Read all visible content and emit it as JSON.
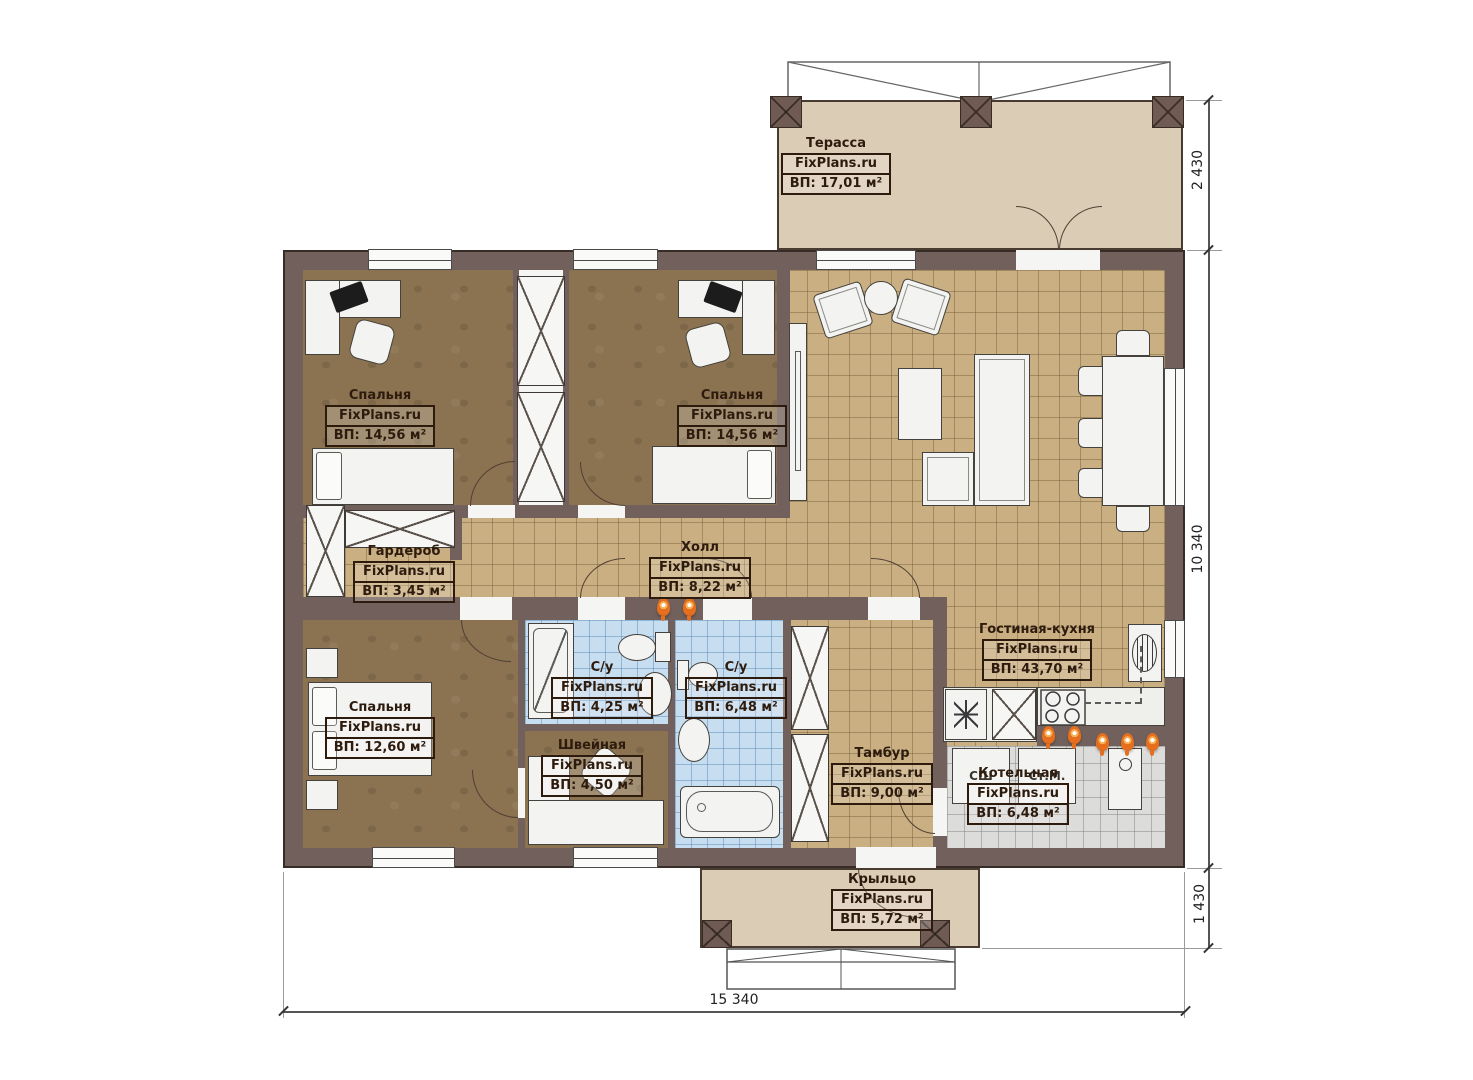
{
  "watermark": "FixPlans.ru",
  "rooms": {
    "terrace": {
      "name": "Терасса",
      "area": "ВП: 17,01 м²"
    },
    "bedroom_top_left": {
      "name": "Спальня",
      "area": "ВП: 14,56 м²"
    },
    "bedroom_top_middle": {
      "name": "Спальня",
      "area": "ВП: 14,56 м²"
    },
    "wardrobe": {
      "name": "Гардероб",
      "area": "ВП: 3,45 м²"
    },
    "hall": {
      "name": "Холл",
      "area": "ВП: 8,22 м²"
    },
    "living_kitchen": {
      "name": "Гостиная-кухня",
      "area": "ВП: 43,70 м²"
    },
    "bedroom_bottom_left": {
      "name": "Спальня",
      "area": "ВП: 12,60 м²"
    },
    "bathroom_small": {
      "name": "С/у",
      "area": "ВП: 4,25 м²"
    },
    "bathroom_large": {
      "name": "С/у",
      "area": "ВП: 6,48 м²"
    },
    "sewing": {
      "name": "Швейная",
      "area": "ВП: 4,50 м²"
    },
    "vestibule": {
      "name": "Тамбур",
      "area": "ВП: 9,00 м²"
    },
    "boiler": {
      "name": "Котельная",
      "area": "ВП: 6,48 м²"
    },
    "porch": {
      "name": "Крыльцо",
      "area": "ВП: 5,72 м²"
    }
  },
  "appliances": {
    "dryer_label": "СШ",
    "washer_label": "Ст.М."
  },
  "dimensions": {
    "terrace_depth": "2 430",
    "house_depth": "10 340",
    "porch_depth": "1 430",
    "house_width": "15 340"
  },
  "colors": {
    "wall": "#71605b",
    "floor_tile_tan": "#c9af82",
    "floor_wood_brown": "#8b7351",
    "floor_tile_blue": "#c7ddf0",
    "floor_tile_grey": "#dcdcda",
    "terrace_fill": "#dbccb6",
    "accent_orange": "#e66f1e",
    "label_ink": "#2d1b0e"
  }
}
